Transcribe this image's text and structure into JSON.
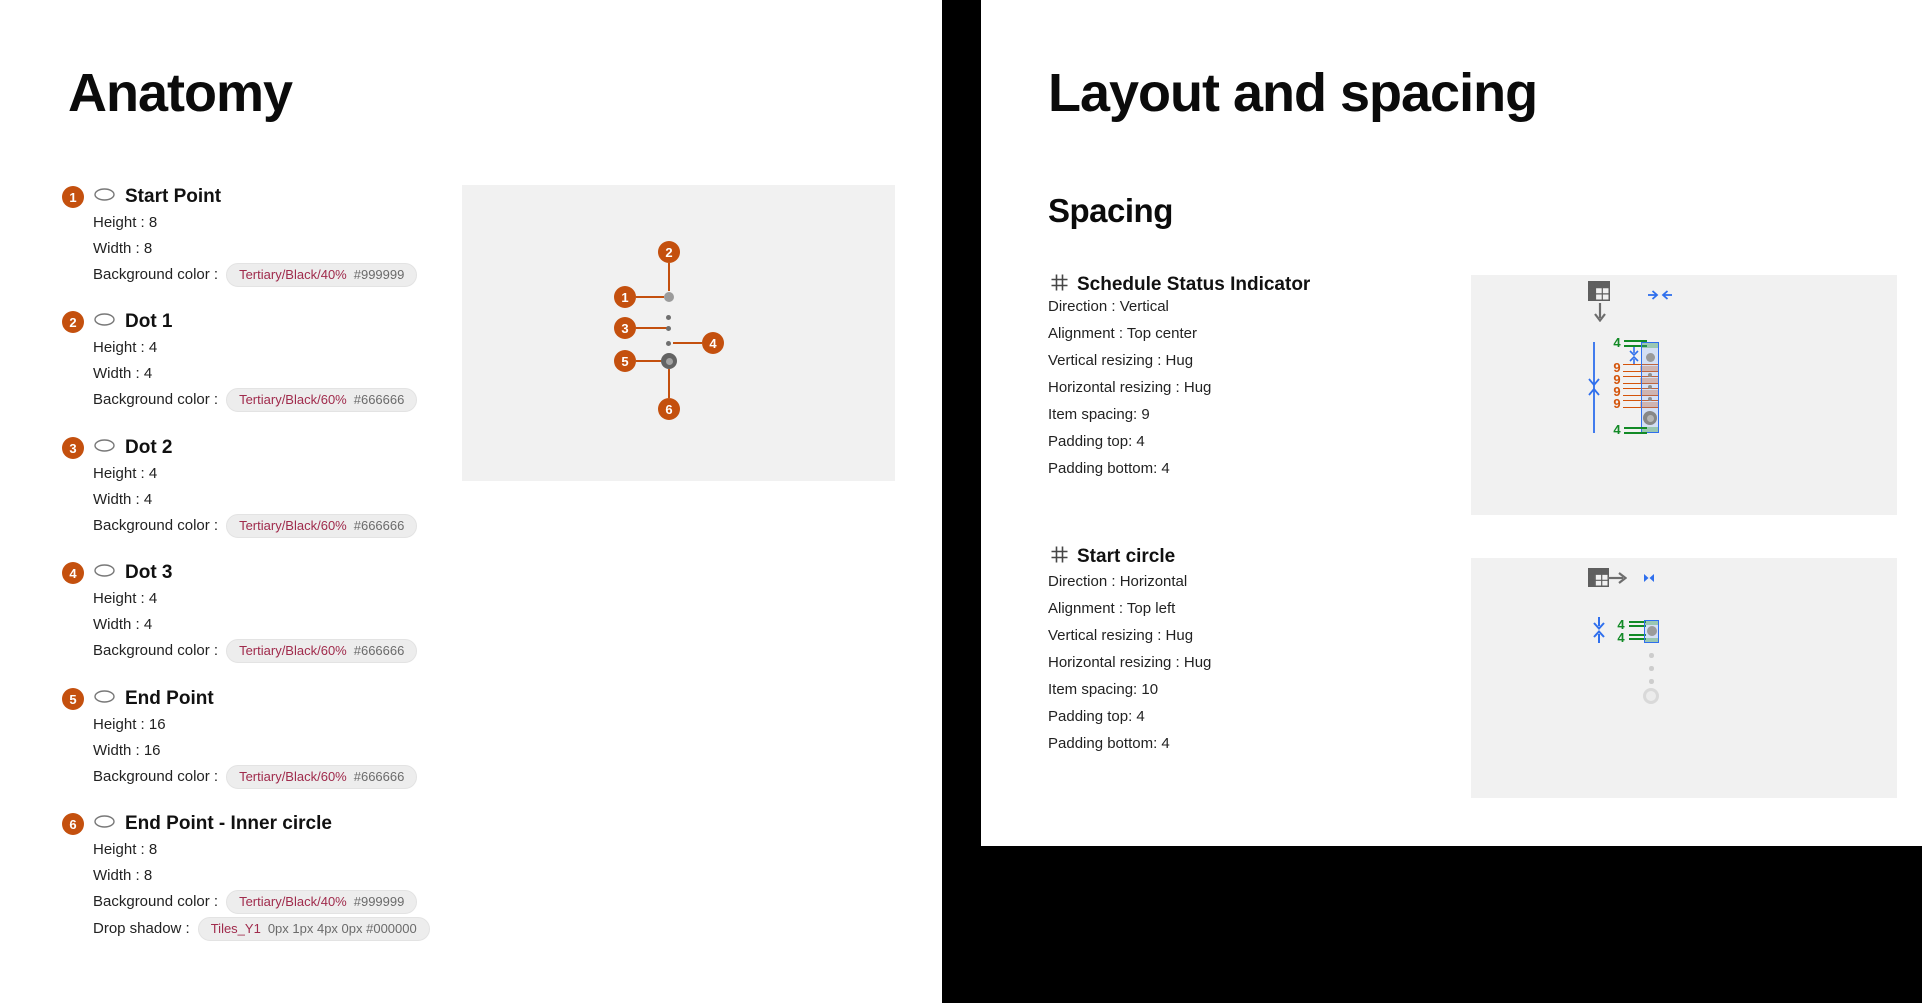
{
  "colors": {
    "badge_orange": "#C4500E",
    "token_text": "#A02B4C",
    "annotation_green": "#128A26",
    "annotation_orange": "#D4540A",
    "annotation_blue": "#2F6FED",
    "canvas_bg": "#F1F1F1",
    "background_black": "#000000"
  },
  "anatomy": {
    "title": "Anatomy",
    "items": [
      {
        "number": "1",
        "name": "Start Point",
        "height": "Height : 8",
        "width": "Width : 8",
        "bg_label": "Background color :",
        "bg_token": "Tertiary/Black/40%",
        "bg_value": "#999999"
      },
      {
        "number": "2",
        "name": "Dot 1",
        "height": "Height : 4",
        "width": "Width : 4",
        "bg_label": "Background color :",
        "bg_token": "Tertiary/Black/60%",
        "bg_value": "#666666"
      },
      {
        "number": "3",
        "name": "Dot 2",
        "height": "Height : 4",
        "width": "Width : 4",
        "bg_label": "Background color :",
        "bg_token": "Tertiary/Black/60%",
        "bg_value": "#666666"
      },
      {
        "number": "4",
        "name": "Dot 3",
        "height": "Height : 4",
        "width": "Width : 4",
        "bg_label": "Background color :",
        "bg_token": "Tertiary/Black/60%",
        "bg_value": "#666666"
      },
      {
        "number": "5",
        "name": "End Point",
        "height": "Height : 16",
        "width": "Width : 16",
        "bg_label": "Background color :",
        "bg_token": "Tertiary/Black/60%",
        "bg_value": "#666666"
      },
      {
        "number": "6",
        "name": "End Point - Inner circle",
        "height": "Height : 8",
        "width": "Width : 8",
        "bg_label": "Background color :",
        "bg_token": "Tertiary/Black/40%",
        "bg_value": "#999999",
        "shadow_label": "Drop shadow :",
        "shadow_token": "Tiles_Y1",
        "shadow_value": "0px 1px 4px 0px #000000"
      }
    ]
  },
  "layout": {
    "title": "Layout and spacing",
    "heading": "Spacing",
    "sections": [
      {
        "name": "Schedule Status Indicator",
        "rows": [
          "Direction : Vertical",
          "Alignment : Top center",
          "Vertical resizing : Hug",
          "Horizontal resizing : Hug",
          "Item spacing: 9",
          "Padding top: 4",
          "Padding bottom: 4"
        ],
        "diagram": {
          "padding_top": "4",
          "padding_bottom": "4",
          "gaps": [
            "9",
            "9",
            "9",
            "9"
          ]
        }
      },
      {
        "name": "Start circle",
        "rows": [
          "Direction : Horizontal",
          "Alignment : Top left",
          "Vertical resizing : Hug",
          "Horizontal resizing : Hug",
          "Item spacing: 10",
          "Padding top: 4",
          "Padding bottom: 4"
        ],
        "diagram": {
          "padding_top": "4",
          "padding_bottom": "4"
        }
      }
    ]
  }
}
